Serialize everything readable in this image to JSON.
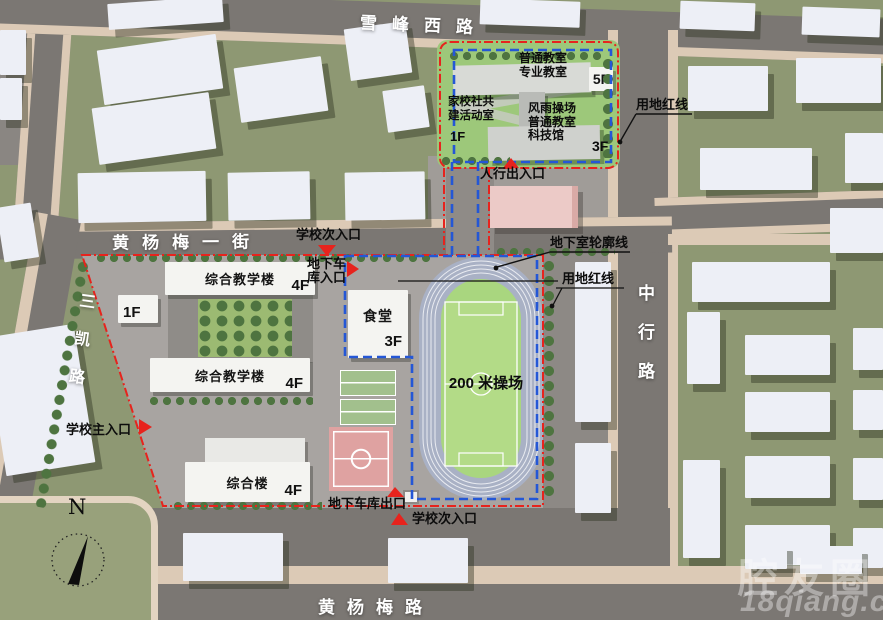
{
  "colors": {
    "boundary_red_line": "#e7231d",
    "basement_blue_line": "#2457d6",
    "field_green": "#a9d67f",
    "track_blue_gray": "#a9b1c5",
    "road_gray": "#7b7773",
    "sidewalk_beige": "#dccab6",
    "block_olive": "#8e9873"
  },
  "roads": {
    "xuefeng_west": "雪峰西路",
    "huangyangmei_first_street": "黄杨梅一街",
    "huangyangmei_road": "黄杨梅路",
    "sankai_road": "三凯路",
    "zhonghang_road": "中行路"
  },
  "north_site": {
    "classroom_label": "普通教室\n专业教室",
    "classroom_floor": "5F",
    "community_label": "家校社共\n建活动室",
    "community_floor": "1F",
    "gym_label": "风雨操场\n普通教室\n科技馆",
    "gym_floor": "3F"
  },
  "school": {
    "teaching_building_1": "综合教学楼",
    "teaching_building_1_floor": "4F",
    "annex_floor": "1F",
    "teaching_building_2": "综合教学楼",
    "teaching_building_2_floor": "4F",
    "canteen": "食堂",
    "canteen_floor": "3F",
    "complex_building": "综合楼",
    "complex_building_floor": "4F",
    "playground": "200 米操场"
  },
  "annotations": {
    "land_red_line_top": "用地红线",
    "basement_outline": "地下室轮廓线",
    "land_red_line_mid": "用地红线",
    "pedestrian_entrance": "人行出入口",
    "secondary_entrance_top": "学校次入口",
    "garage_entrance": "地下车\n库入口",
    "main_entrance": "学校主入口",
    "garage_exit": "地下车库出口",
    "secondary_entrance_bottom": "学校次入口"
  },
  "compass": {
    "north": "N"
  },
  "watermark": {
    "name": "腔友圈",
    "site": "18qiang.com"
  }
}
